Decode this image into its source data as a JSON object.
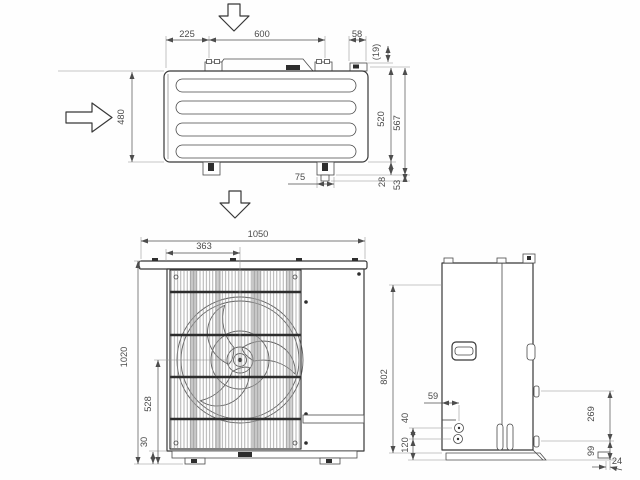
{
  "drawing": {
    "kind": "outdoor-unit-dimensional-drawing",
    "units": "mm",
    "line_color": "#383838",
    "dim_color": "#4a4a4a"
  },
  "dims": {
    "top": {
      "foot_pitch_left": "225",
      "foot_pitch_center": "600",
      "bracket_width": "58",
      "bracket_offset": "(19)",
      "body_depth": "480",
      "depth_to_foot": "520",
      "overall_depth": "567",
      "foot_offset_rear": "28",
      "foot_overall_rear": "53",
      "foot_slot_width": "75"
    },
    "front": {
      "overall_width": "1050",
      "fan_center_x": "363",
      "overall_height": "1020",
      "fan_center_y": "528",
      "base_height": "30"
    },
    "side": {
      "rear_panel_height": "802",
      "pipe_offset": "59",
      "pipe_spacing": "40",
      "pipe_base_height": "120",
      "hanger_pitch": "269",
      "hanger_base_offset": "99",
      "base_lip": "24"
    }
  },
  "icons": {
    "airflow_top": "hollow-down-arrow",
    "airflow_left": "hollow-right-arrow",
    "airflow_bottom": "hollow-down-arrow"
  }
}
